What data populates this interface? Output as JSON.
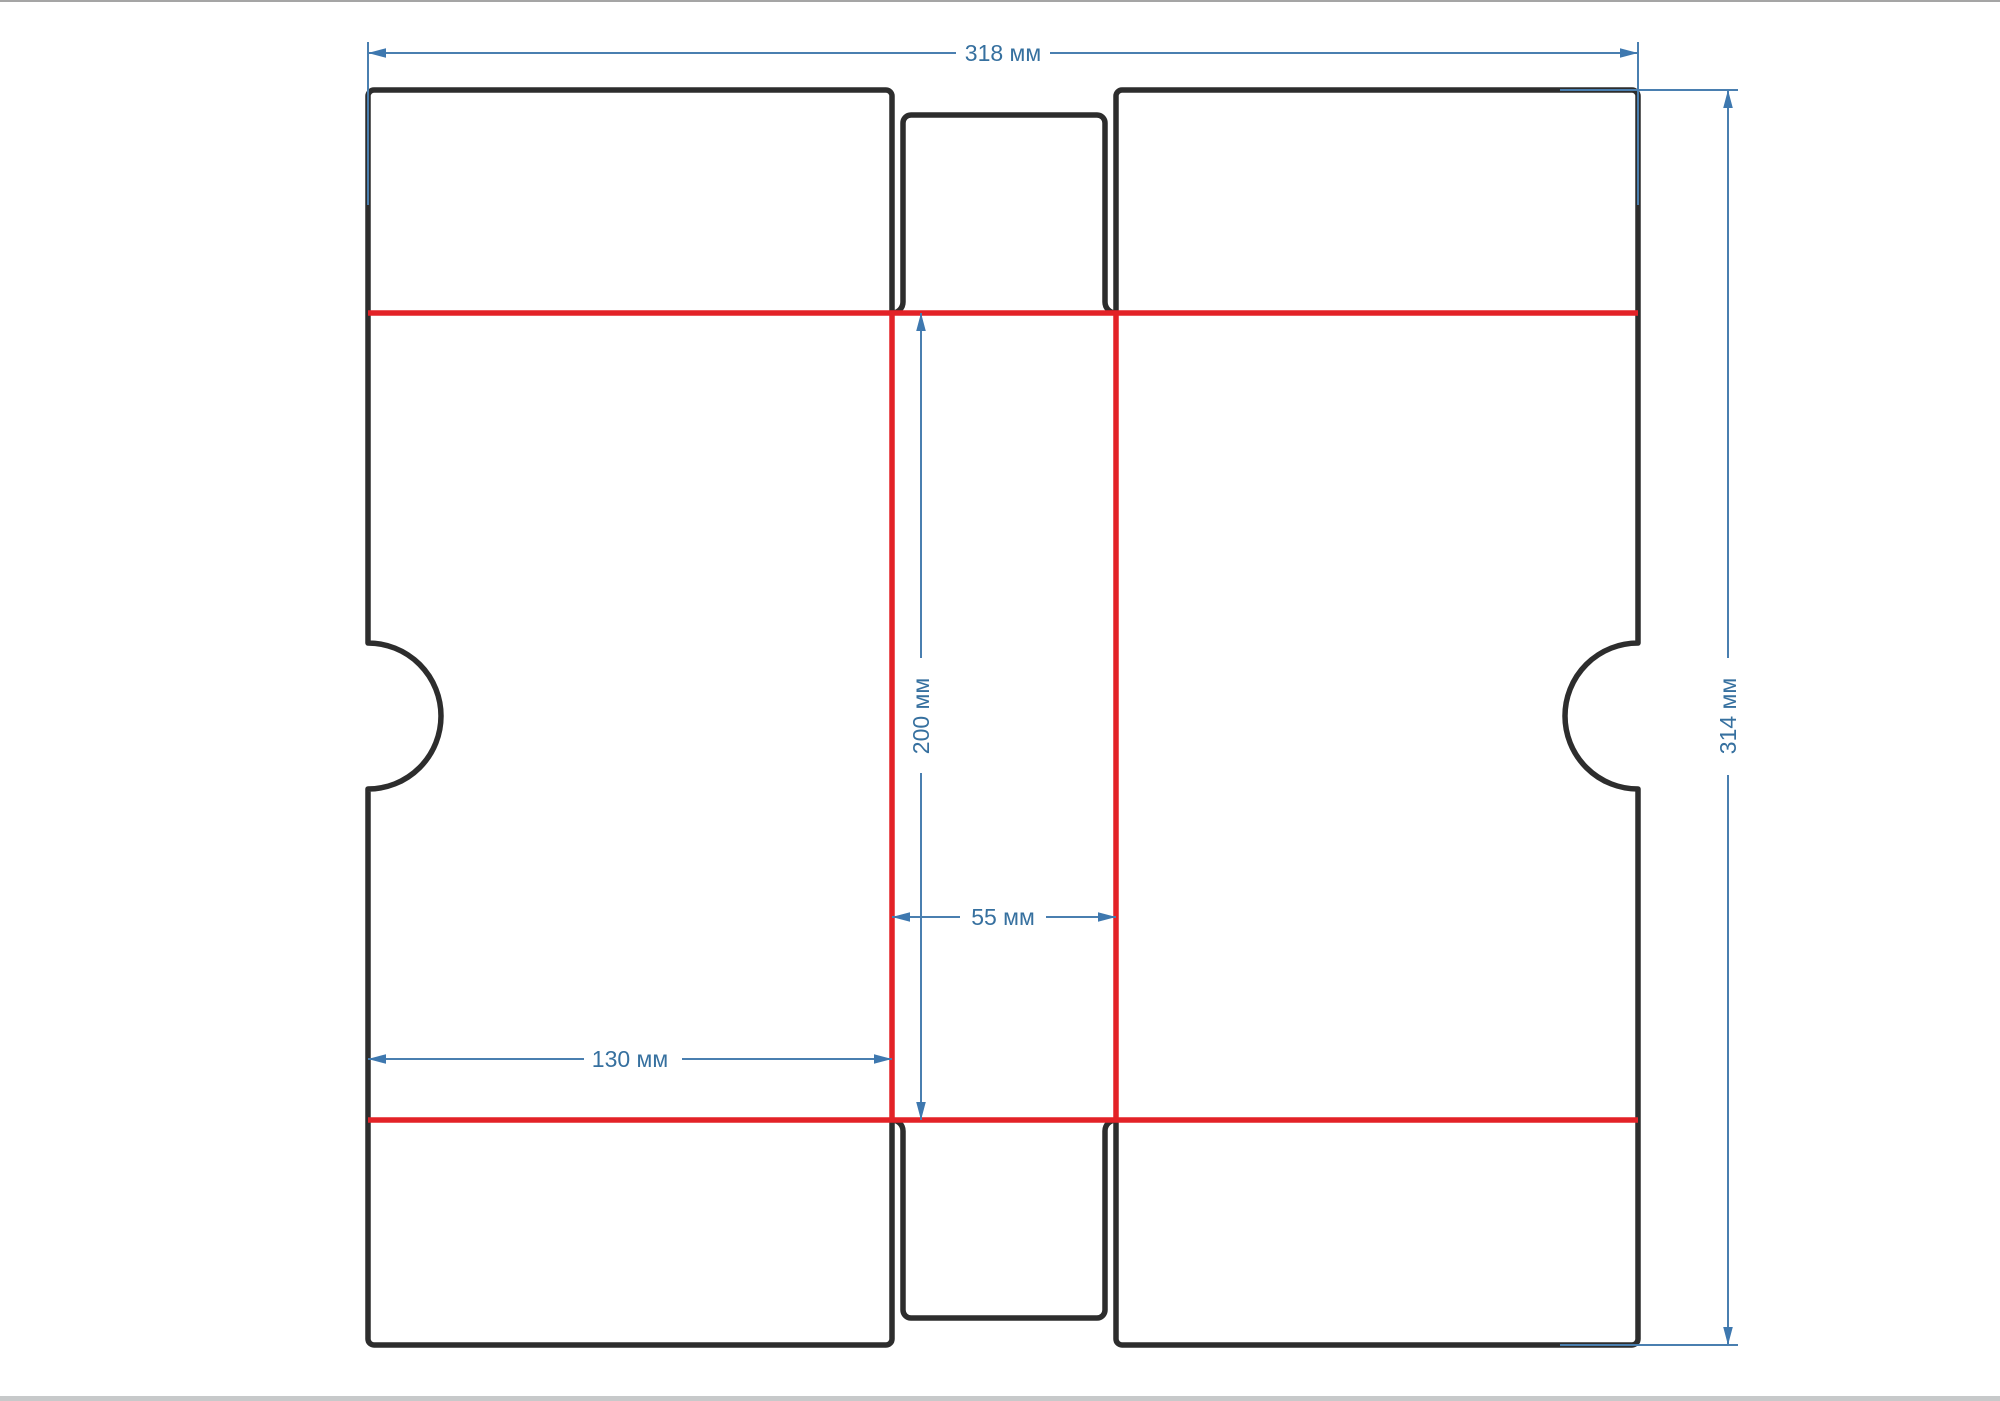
{
  "page": {
    "background": "#ffffff",
    "top_edge_color": "#a5a5a5",
    "bottom_edge_color": "#c7c9ca"
  },
  "dieline": {
    "type": "box-packaging-dieline",
    "units": "мм",
    "cut_line_color": "#2d2d2d",
    "fold_line_color": "#e32227",
    "dimension_color": "#3e78af",
    "labels": {
      "total_width": "318 мм",
      "total_height": "314 мм",
      "middle_column_height": "200 мм",
      "middle_column_width": "55 мм",
      "left_panel_width": "130 мм"
    }
  }
}
